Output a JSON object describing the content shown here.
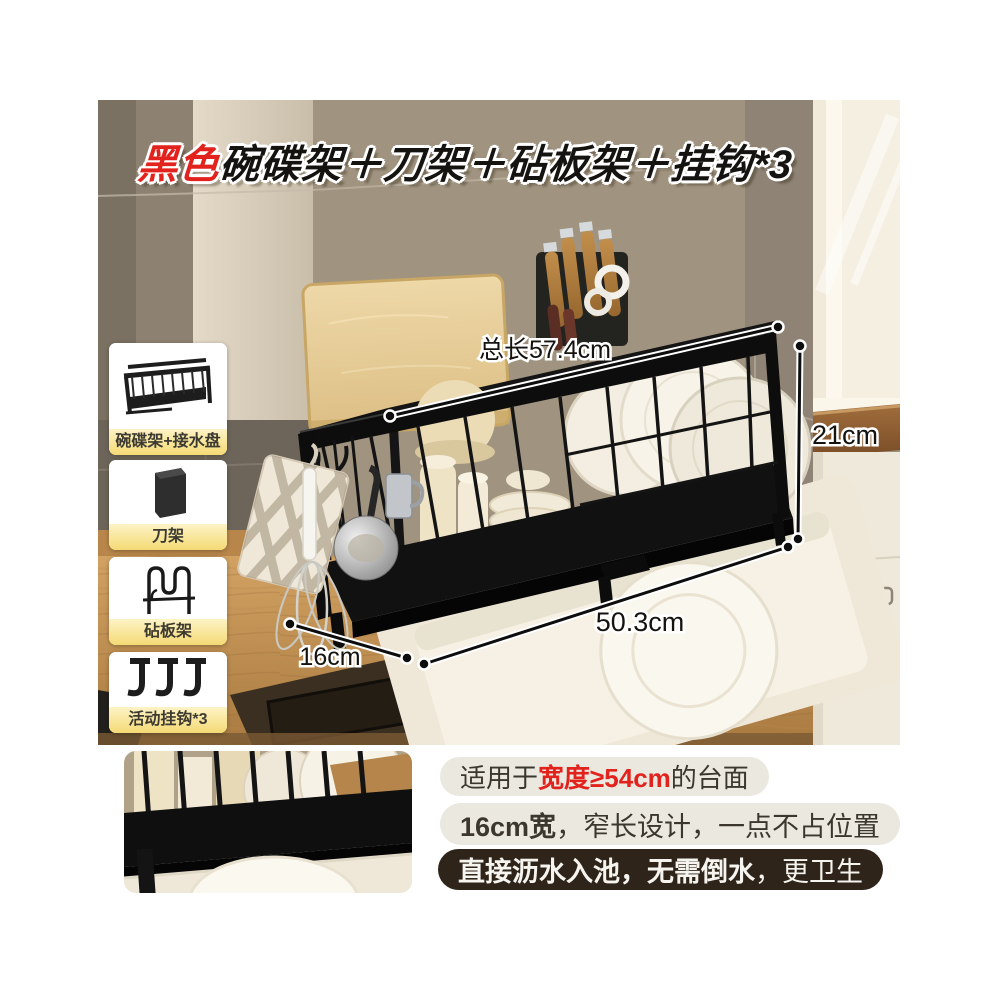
{
  "title": {
    "highlight": "黑色",
    "rest": "碗碟架＋刀架＋砧板架＋挂钩*3"
  },
  "thumbs": {
    "items": [
      {
        "label": "碗碟架+接水盘"
      },
      {
        "label": "刀架"
      },
      {
        "label": "砧板架"
      },
      {
        "label": "活动挂钩*3"
      }
    ]
  },
  "dims": {
    "total": "总长57.4cm",
    "height": "21cm",
    "inner": "50.3cm",
    "depth": "16cm"
  },
  "notes": [
    {
      "pre": "适用于",
      "em": "宽度≥54cm",
      "post": "的台面"
    },
    {
      "pre": "",
      "em": "16cm宽",
      "post": "，窄长设计，一点不占位置"
    },
    {
      "pre": "",
      "em": "直接沥水入池，无需倒水",
      "post": "，更卫生"
    }
  ],
  "colors": {
    "accent_red": "#e2231d",
    "label_bar_yellow": "#f4da74",
    "pill_light_bg": "#ebe8df",
    "pill_dark_bg": "#2e241a",
    "rack_black": "#111111",
    "wall_taupe": "#9a8f7d",
    "counter_wood": "#c89a58"
  }
}
